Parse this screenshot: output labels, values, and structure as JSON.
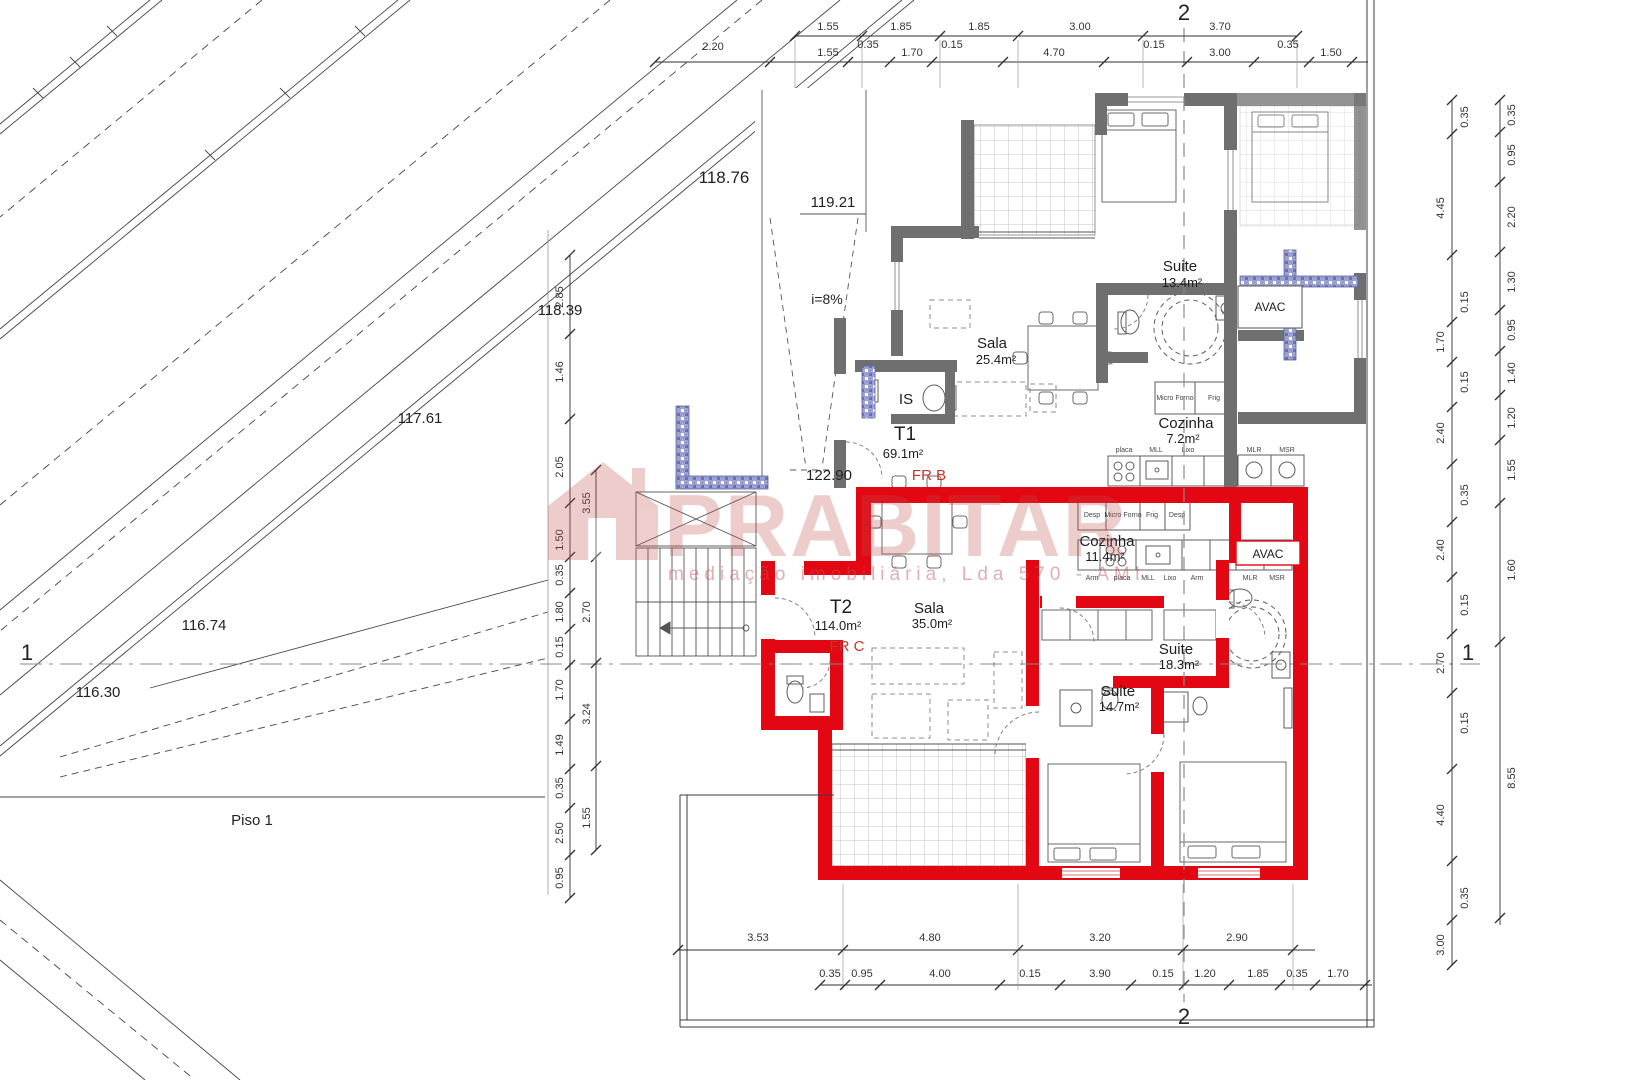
{
  "sections": {
    "top": "2",
    "bottom": "2",
    "left": "1",
    "right": "1"
  },
  "elevations": {
    "a": "118.76",
    "b": "119.21",
    "c": "118.39",
    "d": "117.61",
    "e": "116.74",
    "f": "116.30",
    "g": "122.90"
  },
  "annotations": {
    "slope": "i=8%",
    "floor": "Piso 1"
  },
  "watermark": {
    "brand": "PRABITAR",
    "subtitle": "mediação imobiliária, Lda 570 - AMI"
  },
  "units": {
    "t1": {
      "code": "T1",
      "area": "69.1m²",
      "fraction": "FR B"
    },
    "t2": {
      "code": "T2",
      "area": "114.0m²",
      "fraction": "FR C"
    }
  },
  "rooms": {
    "suite1": {
      "name": "Suite",
      "area": "13.4m²"
    },
    "sala1": {
      "name": "Sala",
      "area": "25.4m²"
    },
    "cozinha1": {
      "name": "Cozinha",
      "area": "7.2m²"
    },
    "is1": {
      "name": "IS"
    },
    "avac1": {
      "name": "AVAC"
    },
    "cozinha2": {
      "name": "Cozinha",
      "area": "11.4m²"
    },
    "sala2": {
      "name": "Sala",
      "area": "35.0m²"
    },
    "suite2": {
      "name": "Suite",
      "area": "18.3m²"
    },
    "suite3": {
      "name": "Suite",
      "area": "14.7m²"
    },
    "avac2": {
      "name": "AVAC"
    }
  },
  "kitchen1": {
    "appliances_top": [
      "Micro Forno",
      "Frig"
    ],
    "counter": [
      "placa",
      "MLL",
      "Lixo",
      "MLR",
      "MSR"
    ]
  },
  "kitchen2": {
    "appliances_top": [
      "Desp",
      "Micro Forno",
      "Frig",
      "Desp"
    ],
    "counter": [
      "Arm",
      "placa",
      "MLL",
      "Lixo",
      "Arm",
      "Arm",
      "MLR",
      "MSR"
    ]
  },
  "dims": {
    "top_row1": [
      "1.55",
      "1.85",
      "1.85",
      "3.00",
      "3.70"
    ],
    "top_row2": [
      "2.20",
      "1.55",
      "0.35",
      "1.70",
      "0.15",
      "4.70",
      "0.15",
      "3.00",
      "0.35",
      "1.50"
    ],
    "left_a": [
      "2.85",
      "1.46",
      "2.05",
      "1.50",
      "0.35",
      "1.80",
      "0.15",
      "1.70",
      "1.49",
      "0.35",
      "2.50",
      "0.95"
    ],
    "left_b": [
      "3.55",
      "2.70",
      "3.24",
      "1.55"
    ],
    "right_inner_big": [
      "4.45",
      "1.70",
      "2.40",
      "2.40",
      "2.70",
      "4.40",
      "3.00"
    ],
    "right_inner_small": [
      "0.35",
      "0.15",
      "0.15",
      "0.35",
      "0.15",
      "0.15",
      "0.35"
    ],
    "right_outer": [
      "0.35",
      "0.95",
      "2.20",
      "1.30",
      "0.95",
      "1.40",
      "1.20",
      "1.55",
      "1.60",
      "8.55"
    ],
    "bottom_row1": [
      "3.53",
      "4.80",
      "3.20",
      "2.90"
    ],
    "bottom_row2": [
      "0.35",
      "0.95",
      "4.00",
      "0.15",
      "3.90",
      "0.15",
      "1.20",
      "1.85",
      "0.35",
      "1.70"
    ]
  },
  "colors": {
    "red": "#e30613",
    "wall_gray": "#6f6f6f",
    "blue": "#9aa0d0",
    "watermark": "#c0504d"
  }
}
